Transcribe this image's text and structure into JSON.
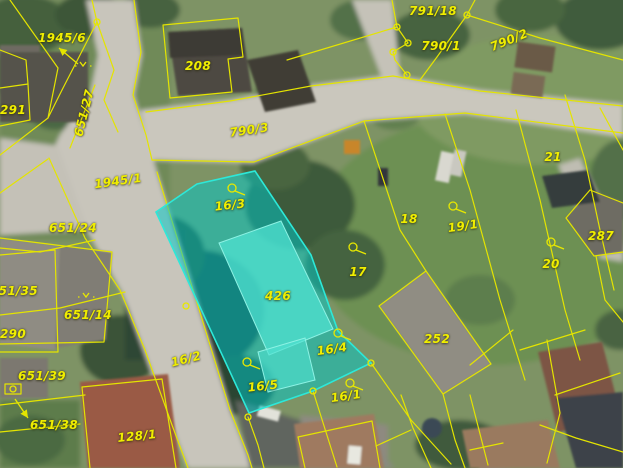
{
  "map": {
    "type": "cadastral-orthophoto",
    "colors": {
      "boundary_line": "#e4e400",
      "label_text": "#f0ee00",
      "highlight_fill": "#00c8c8",
      "highlight_stroke": "#2de8d8",
      "highlight_building_fill": "#4ee0cf"
    },
    "highlight": {
      "covers_labels": [
        "16/3",
        "16/5",
        "426"
      ]
    },
    "parcel_labels": [
      {
        "text": "1945/6",
        "x": 62,
        "y": 38
      },
      {
        "text": "208",
        "x": 198,
        "y": 66
      },
      {
        "text": "791/18",
        "x": 433,
        "y": 11
      },
      {
        "text": "790/1",
        "x": 441,
        "y": 46
      },
      {
        "text": "790/2",
        "x": 509,
        "y": 40,
        "rot": -22
      },
      {
        "text": "291",
        "x": 13,
        "y": 110
      },
      {
        "text": "651/27",
        "x": 84,
        "y": 113,
        "rot": -76
      },
      {
        "text": "790/3",
        "x": 249,
        "y": 130,
        "rot": -8
      },
      {
        "text": "1945/1",
        "x": 118,
        "y": 181,
        "rot": -8
      },
      {
        "text": "21",
        "x": 553,
        "y": 157
      },
      {
        "text": "651/24",
        "x": 73,
        "y": 228
      },
      {
        "text": "16/3",
        "x": 230,
        "y": 205,
        "rot": -6
      },
      {
        "text": "18",
        "x": 409,
        "y": 219
      },
      {
        "text": "19/1",
        "x": 463,
        "y": 226,
        "rot": -8
      },
      {
        "text": "287",
        "x": 601,
        "y": 236
      },
      {
        "text": "17",
        "x": 358,
        "y": 272
      },
      {
        "text": "20",
        "x": 551,
        "y": 264
      },
      {
        "text": "651/35",
        "x": 14,
        "y": 291
      },
      {
        "text": "651/14",
        "x": 88,
        "y": 315
      },
      {
        "text": "290",
        "x": 13,
        "y": 334
      },
      {
        "text": "426",
        "x": 278,
        "y": 296
      },
      {
        "text": "252",
        "x": 437,
        "y": 339
      },
      {
        "text": "16/4",
        "x": 332,
        "y": 349,
        "rot": -8
      },
      {
        "text": "16/2",
        "x": 186,
        "y": 359,
        "rot": -14
      },
      {
        "text": "651/39",
        "x": 42,
        "y": 376
      },
      {
        "text": "16/5",
        "x": 263,
        "y": 386,
        "rot": -6
      },
      {
        "text": "16/1",
        "x": 346,
        "y": 396,
        "rot": -8
      },
      {
        "text": "651/38",
        "x": 54,
        "y": 425
      },
      {
        "text": "128/1",
        "x": 137,
        "y": 436,
        "rot": -6
      }
    ],
    "symbols": [
      {
        "type": "circle-flag",
        "x": 232,
        "y": 188
      },
      {
        "type": "circle-flag",
        "x": 353,
        "y": 247
      },
      {
        "type": "circle-flag",
        "x": 453,
        "y": 206
      },
      {
        "type": "circle-flag",
        "x": 551,
        "y": 242
      },
      {
        "type": "circle-flag",
        "x": 338,
        "y": 333
      },
      {
        "type": "circle-flag",
        "x": 350,
        "y": 383
      },
      {
        "type": "circle-flag",
        "x": 247,
        "y": 362
      },
      {
        "type": "vertex-circle",
        "x": 97,
        "y": 22
      },
      {
        "type": "vertex-circle",
        "x": 397,
        "y": 27
      },
      {
        "type": "vertex-circle",
        "x": 408,
        "y": 43
      },
      {
        "type": "vertex-circle",
        "x": 393,
        "y": 52
      },
      {
        "type": "vertex-circle",
        "x": 407,
        "y": 75
      },
      {
        "type": "vertex-circle",
        "x": 467,
        "y": 15
      },
      {
        "type": "vertex-circle",
        "x": 248,
        "y": 417
      },
      {
        "type": "vertex-circle",
        "x": 313,
        "y": 391
      },
      {
        "type": "vertex-circle",
        "x": 371,
        "y": 363
      },
      {
        "type": "vertex-circle",
        "x": 186,
        "y": 306
      },
      {
        "type": "vertex-circle",
        "x": 13,
        "y": 389
      },
      {
        "type": "scrub",
        "x": 83,
        "y": 62
      },
      {
        "type": "scrub",
        "x": 86,
        "y": 293
      },
      {
        "type": "arrow",
        "x1": 78,
        "y1": 64,
        "x2": 59,
        "y2": 48
      },
      {
        "type": "arrow",
        "x1": 15,
        "y1": 399,
        "x2": 28,
        "y2": 418
      }
    ]
  }
}
